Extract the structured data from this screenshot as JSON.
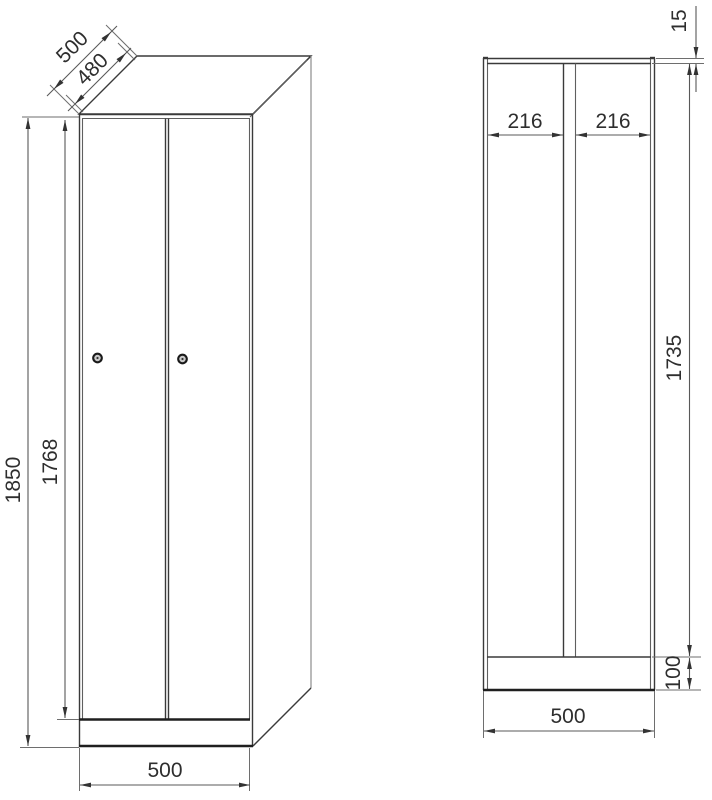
{
  "drawing": {
    "title": "two-door locker technical drawing",
    "front": {
      "height_total": "1850",
      "height_door": "1768",
      "width": "500",
      "depth": "500",
      "depth_top": "480",
      "lock_count": 2
    },
    "section": {
      "top_gap": "15",
      "compartment_left": "216",
      "compartment_right": "216",
      "inner_height": "1735",
      "base_height": "100",
      "width": "500"
    },
    "colors": {
      "background": "#ffffff",
      "object_line": "#3a3a3a",
      "thick_line": "#1f1f1f",
      "projection_line": "#8c8c8c",
      "dimension_line": "#585858",
      "text": "#2e2e2e"
    }
  }
}
